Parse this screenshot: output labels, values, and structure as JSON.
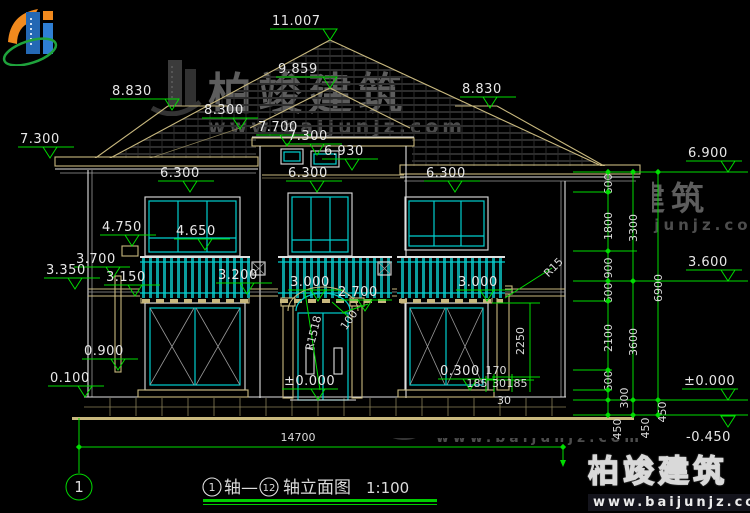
{
  "drawing": {
    "type_note": "architectural elevation, CAD style",
    "scale_label": "1:100"
  },
  "title_block": {
    "axis_start": "1",
    "axis_end": "12",
    "title_mid": "轴—",
    "title_main": "轴立面图",
    "scale": "1:100",
    "sheet_no": "1"
  },
  "watermark": {
    "brand": "柏竣建筑",
    "url": "www.baijunjz.com"
  },
  "elevation_markers": [
    {
      "label": "11.007",
      "x": 330,
      "y": 40,
      "tx": 272
    },
    {
      "label": "9.859",
      "x": 330,
      "y": 88,
      "tx": 278
    },
    {
      "label": "8.830",
      "x": 172,
      "y": 110,
      "tx": 112
    },
    {
      "label": "8.830",
      "x": 490,
      "y": 108,
      "tx": 462
    },
    {
      "label": "8.300",
      "x": 240,
      "y": 129,
      "tx": 204
    },
    {
      "label": "7.700",
      "x": 287,
      "y": 146,
      "tx": 258
    },
    {
      "label": "7.300",
      "x": 50,
      "y": 158,
      "tx": 20
    },
    {
      "label": "7.300",
      "x": 317,
      "y": 155,
      "tx": 288
    },
    {
      "label": "6.930",
      "x": 352,
      "y": 170,
      "tx": 324
    },
    {
      "label": "6.900",
      "x": 728,
      "y": 172,
      "tx": 688
    },
    {
      "label": "6.300",
      "x": 190,
      "y": 192,
      "tx": 160
    },
    {
      "label": "6.300",
      "x": 317,
      "y": 192,
      "tx": 288
    },
    {
      "label": "6.300",
      "x": 455,
      "y": 192,
      "tx": 426
    },
    {
      "label": "4.750",
      "x": 132,
      "y": 246,
      "tx": 102
    },
    {
      "label": "4.650",
      "x": 205,
      "y": 250,
      "tx": 176
    },
    {
      "label": "3.700",
      "x": 113,
      "y": 278,
      "tx": 76
    },
    {
      "label": "3.350",
      "x": 75,
      "y": 289,
      "tx": 46
    },
    {
      "label": "3.150",
      "x": 135,
      "y": 296,
      "tx": 106
    },
    {
      "label": "3.200",
      "x": 247,
      "y": 294,
      "tx": 218
    },
    {
      "label": "3.000",
      "x": 318,
      "y": 301,
      "tx": 290
    },
    {
      "label": "3.000",
      "x": 487,
      "y": 301,
      "tx": 458
    },
    {
      "label": "2.700",
      "x": 365,
      "y": 311,
      "tx": 338
    },
    {
      "label": "0.900",
      "x": 118,
      "y": 370,
      "tx": 84
    },
    {
      "label": "0.300",
      "x": 470,
      "y": 390,
      "tx": 440
    },
    {
      "label": "0.100",
      "x": 85,
      "y": 397,
      "tx": 50
    },
    {
      "label": "±0.000",
      "x": 318,
      "y": 400,
      "tx": 284
    },
    {
      "label": "±0.000",
      "x": 728,
      "y": 400,
      "tx": 684
    },
    {
      "label": "3.600",
      "x": 728,
      "y": 281,
      "tx": 688
    },
    {
      "label": "-0.450",
      "x": 728,
      "y": 415,
      "tx": 686,
      "below": true
    }
  ],
  "dim_labels": [
    {
      "t": "600",
      "x": 612,
      "y": 184,
      "r": -90
    },
    {
      "t": "1800",
      "x": 612,
      "y": 226,
      "r": -90
    },
    {
      "t": "900",
      "x": 612,
      "y": 268,
      "r": -90
    },
    {
      "t": "600",
      "x": 612,
      "y": 293,
      "r": -90
    },
    {
      "t": "2100",
      "x": 612,
      "y": 338,
      "r": -90
    },
    {
      "t": "600",
      "x": 612,
      "y": 381,
      "r": -90
    },
    {
      "t": "300",
      "x": 628,
      "y": 398,
      "r": -90
    },
    {
      "t": "450",
      "x": 621,
      "y": 429,
      "r": -90
    },
    {
      "t": "3300",
      "x": 637,
      "y": 228,
      "r": -90
    },
    {
      "t": "3600",
      "x": 637,
      "y": 342,
      "r": -90
    },
    {
      "t": "450",
      "x": 649,
      "y": 428,
      "r": -90
    },
    {
      "t": "6900",
      "x": 662,
      "y": 288,
      "r": -90
    },
    {
      "t": "450",
      "x": 666,
      "y": 412,
      "r": -90
    },
    {
      "t": "2250",
      "x": 524,
      "y": 341,
      "r": -90
    },
    {
      "t": "R1518",
      "x": 317,
      "y": 334,
      "r": -76
    },
    {
      "t": "100",
      "x": 352,
      "y": 322,
      "r": -55
    },
    {
      "t": "R15",
      "x": 556,
      "y": 270,
      "r": -45
    },
    {
      "t": "170",
      "x": 496,
      "y": 374,
      "r": 0
    },
    {
      "t": "185",
      "x": 477,
      "y": 387,
      "r": 0
    },
    {
      "t": "30",
      "x": 499,
      "y": 387,
      "r": 0
    },
    {
      "t": "185",
      "x": 517,
      "y": 387,
      "r": 0
    },
    {
      "t": "30",
      "x": 504,
      "y": 404,
      "r": 0
    },
    {
      "t": "14700",
      "x": 298,
      "y": 441,
      "r": 0
    }
  ]
}
